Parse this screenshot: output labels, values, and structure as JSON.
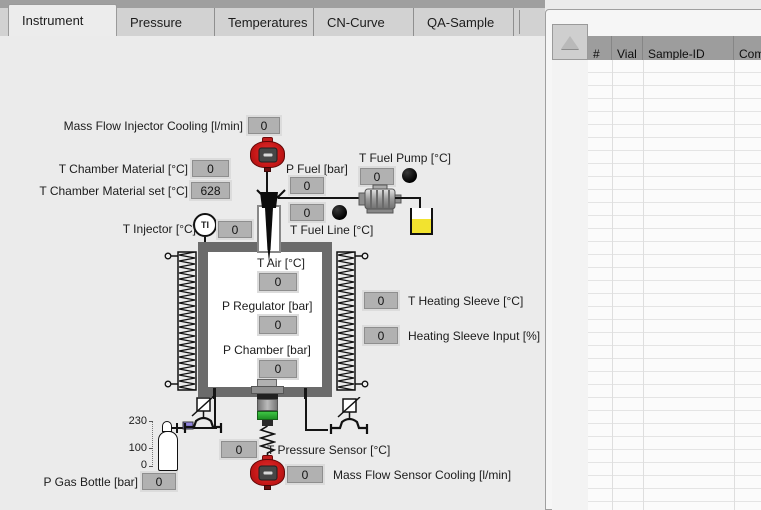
{
  "tabs": {
    "items": [
      {
        "label": "Instrument"
      },
      {
        "label": "Pressure"
      },
      {
        "label": "Temperatures"
      },
      {
        "label": "CN-Curve"
      },
      {
        "label": "QA-Sample"
      }
    ]
  },
  "sample_table": {
    "columns": [
      "#",
      "Vial",
      "Sample-ID",
      "Com"
    ]
  },
  "instrument": {
    "mass_flow_injector_cooling": {
      "label": "Mass Flow Injector Cooling [l/min]",
      "value": "0"
    },
    "t_chamber_material": {
      "label": "T Chamber Material [°C]",
      "value": "0"
    },
    "t_chamber_material_set": {
      "label": "T Chamber Material set [°C]",
      "value": "628"
    },
    "t_injector": {
      "label": "T Injector [°C]",
      "value": "0"
    },
    "p_fuel": {
      "label": "P Fuel [bar]",
      "value": "0"
    },
    "t_fuel_pump": {
      "label": "T Fuel Pump [°C]",
      "value": "0"
    },
    "t_fuel_line": {
      "label": "T Fuel Line [°C]",
      "value": "0"
    },
    "t_air": {
      "label": "T Air [°C]",
      "value": "0"
    },
    "p_regulator": {
      "label": "P Regulator [bar]",
      "value": "0"
    },
    "p_chamber": {
      "label": "P Chamber [bar]",
      "value": "0"
    },
    "t_heating_sleeve": {
      "label": "T Heating Sleeve [°C]",
      "value": "0"
    },
    "heating_sleeve_input": {
      "label": "Heating Sleeve Input [%]",
      "value": "0"
    },
    "t_pressure_sensor": {
      "label": "T Pressure Sensor [°C]",
      "value": "0"
    },
    "mass_flow_sensor_cooling": {
      "label": "Mass Flow Sensor Cooling [l/min]",
      "value": "0"
    },
    "p_gas_bottle": {
      "label": "P Gas Bottle [bar]",
      "value": "0"
    }
  },
  "gas_scale": {
    "ticks": [
      "230",
      "100",
      "0"
    ]
  },
  "indicators": {
    "ti": "TI"
  },
  "colors": {
    "accent_red": "#c61717",
    "valve_purple": "#9184e0",
    "fuel_yellow": "#f2e32f",
    "green_band": "#2fb535"
  }
}
